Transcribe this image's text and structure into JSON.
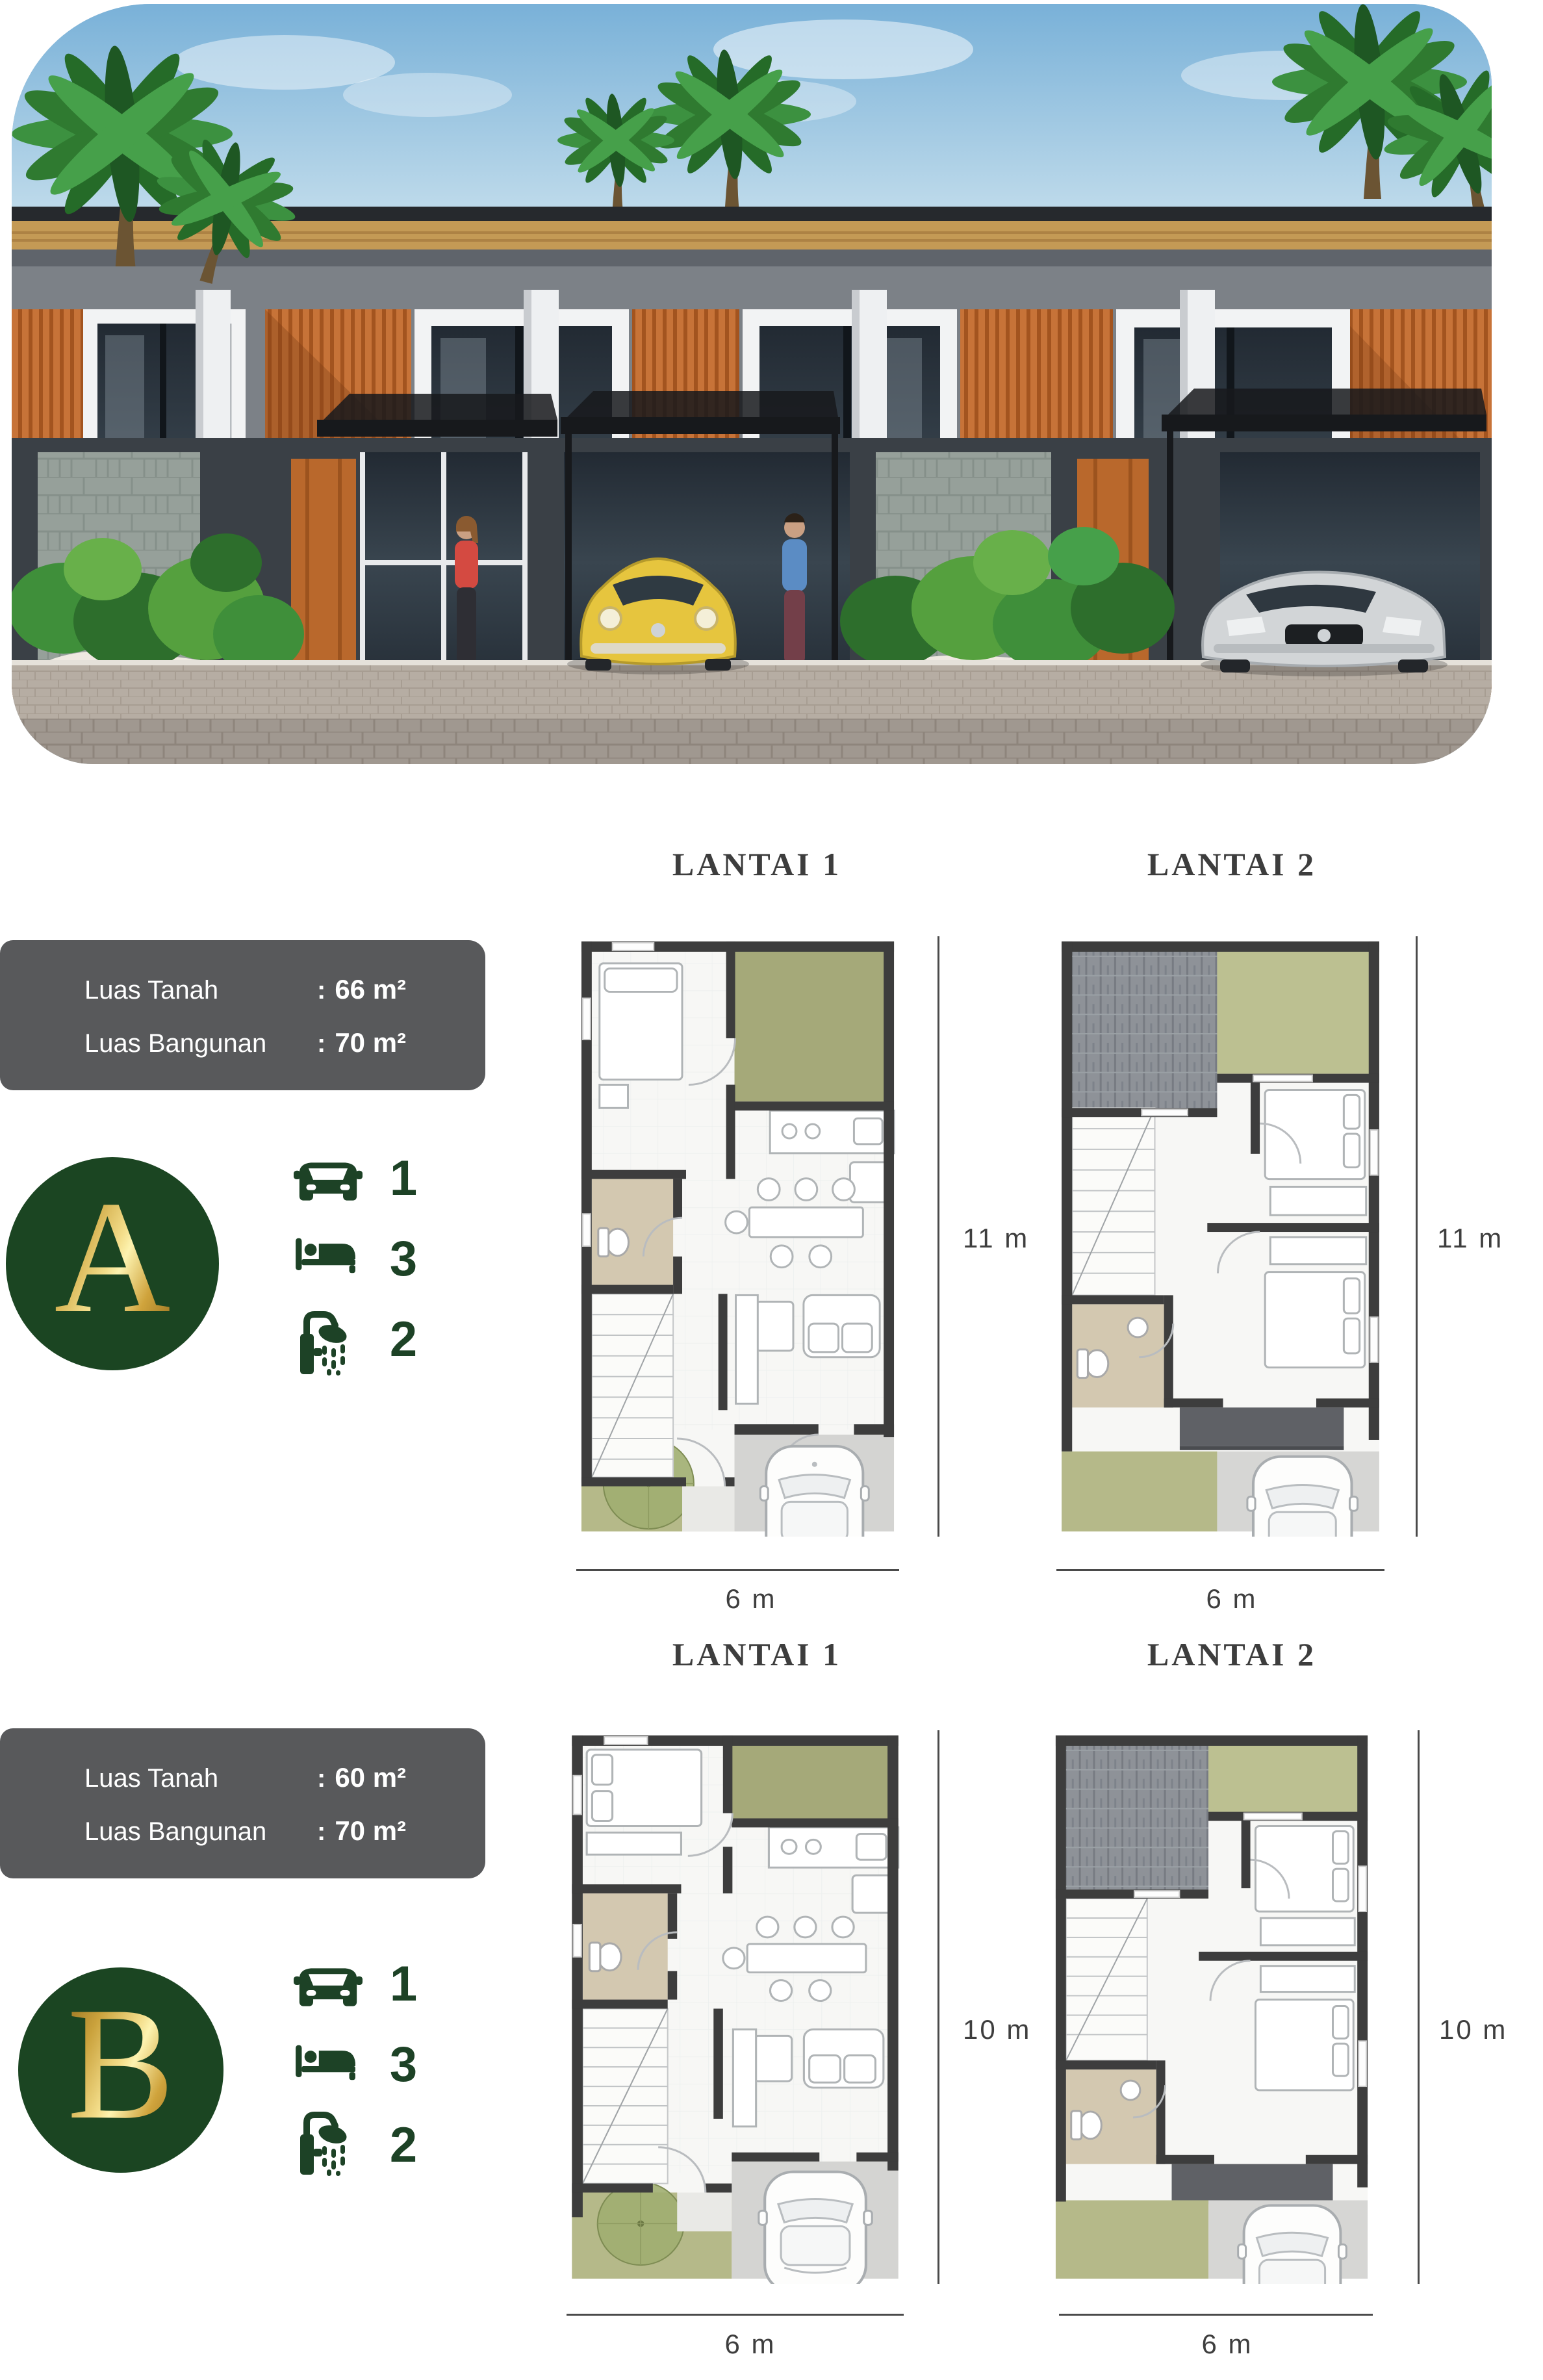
{
  "shared": {
    "colon": ":"
  },
  "palette": {
    "badge_green": "#1b4522",
    "icon_green": "#1d4226",
    "gold_accent": "#f3dd8a",
    "info_box_gray": "#58595b",
    "facade_orange": "#c26f35",
    "plan_garden_green": "#a5a979",
    "plan_bath_tan": "#d3c8b0",
    "plan_wall_dark": "#3d3d3d"
  },
  "types": [
    {
      "badge_letter": "A",
      "info": {
        "rows": [
          {
            "label": "Luas Tanah",
            "value": "66 m²"
          },
          {
            "label": "Luas Bangunan",
            "value": "70 m²"
          }
        ]
      },
      "features": [
        {
          "icon": "car-icon",
          "count": "1"
        },
        {
          "icon": "bed-icon",
          "count": "3"
        },
        {
          "icon": "shower-icon",
          "count": "2"
        }
      ],
      "floors": [
        {
          "title": "LANTAI 1",
          "height_label": "11 m",
          "width_label": "6 m"
        },
        {
          "title": "LANTAI 2",
          "height_label": "11 m",
          "width_label": "6 m"
        }
      ]
    },
    {
      "badge_letter": "B",
      "info": {
        "rows": [
          {
            "label": "Luas Tanah",
            "value": "60 m²"
          },
          {
            "label": "Luas Bangunan",
            "value": "70 m²"
          }
        ]
      },
      "features": [
        {
          "icon": "car-icon",
          "count": "1"
        },
        {
          "icon": "bed-icon",
          "count": "3"
        },
        {
          "icon": "shower-icon",
          "count": "2"
        }
      ],
      "floors": [
        {
          "title": "LANTAI 1",
          "height_label": "10 m",
          "width_label": "6 m"
        },
        {
          "title": "LANTAI 2",
          "height_label": "10 m",
          "width_label": "6 m"
        }
      ]
    }
  ]
}
